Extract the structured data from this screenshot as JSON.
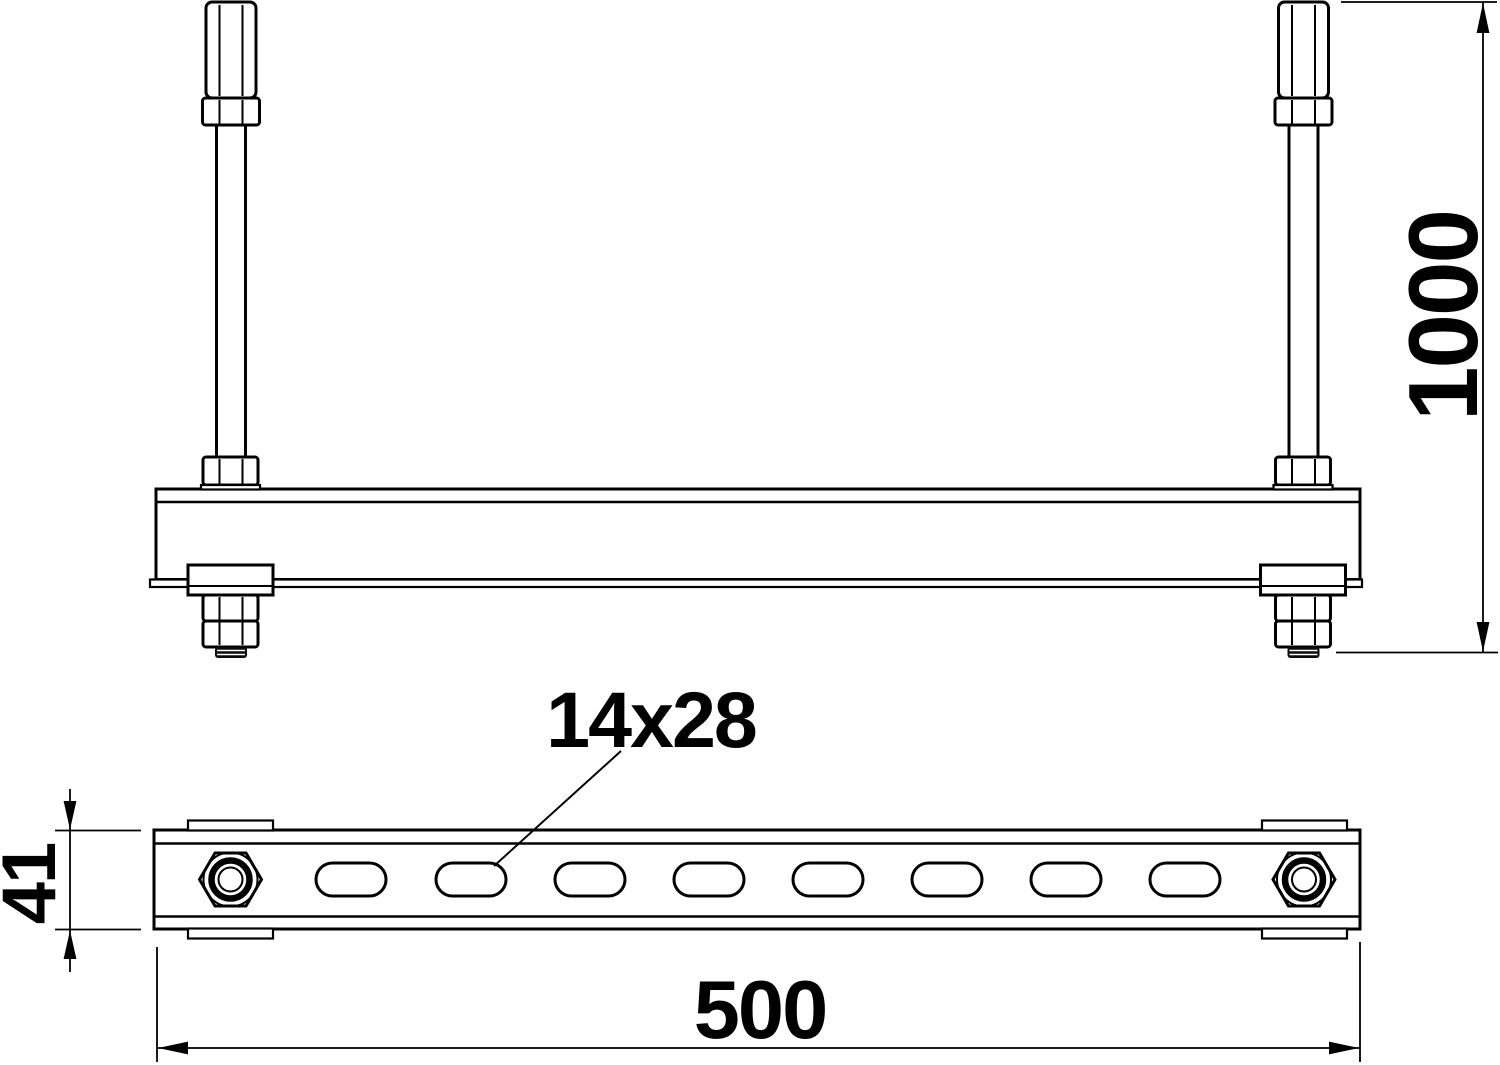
{
  "drawing": {
    "type": "technical-dimension-drawing",
    "background_color": "#ffffff",
    "line_color": "#000000",
    "views": {
      "front_view": {
        "description": "rail suspended on two threaded rods with hex couplers and nuts"
      },
      "top_view": {
        "description": "slotted mounting rail seen from above with end nuts"
      }
    },
    "dimensions": {
      "rod_length": "1000",
      "rail_length": "500",
      "rail_height": "41",
      "slot_size": "14x28"
    },
    "features": {
      "slot_count": 8,
      "rod_count": 2
    }
  }
}
